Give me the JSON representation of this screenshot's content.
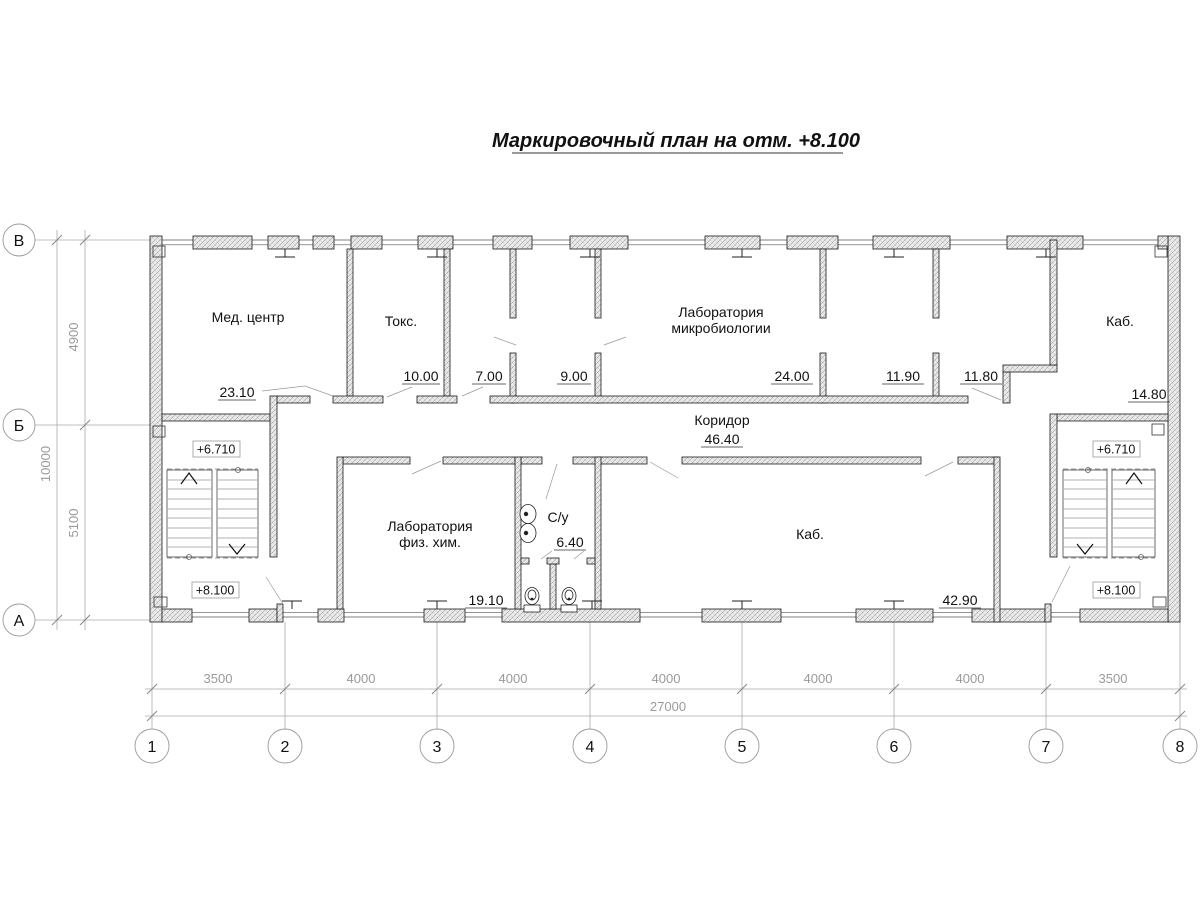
{
  "title": "Маркировочный план на отм. +8.100",
  "rooms": {
    "med_center": {
      "name": "Мед. центр",
      "area": "23.10"
    },
    "toks": {
      "name": "Токс.",
      "area": "10.00"
    },
    "room7": {
      "area": "7.00"
    },
    "room9": {
      "area": "9.00"
    },
    "lab_micro": {
      "line1": "Лаборатория",
      "line2": "микробиологии",
      "area": "24.00"
    },
    "room1190": {
      "area": "11.90"
    },
    "room1180": {
      "area": "11.80"
    },
    "kab_top": {
      "name": "Каб.",
      "area": "14.80"
    },
    "corridor": {
      "name": "Коридор",
      "area": "46.40"
    },
    "lab_fizhim": {
      "line1": "Лаборатория",
      "line2": "физ. хим.",
      "area": "19.10"
    },
    "su": {
      "name": "С/у",
      "area": "6.40"
    },
    "kab_main": {
      "name": "Каб.",
      "area": "42.90"
    }
  },
  "elevations": {
    "upper": "+6.710",
    "lower": "+8.100"
  },
  "axes": {
    "rows": [
      "В",
      "Б",
      "А"
    ],
    "cols": [
      "1",
      "2",
      "3",
      "4",
      "5",
      "6",
      "7",
      "8"
    ]
  },
  "dims": {
    "left": {
      "segments": [
        "4900",
        "5100"
      ],
      "total": "10000"
    },
    "bottom": {
      "segments": [
        "3500",
        "4000",
        "4000",
        "4000",
        "4000",
        "4000",
        "3500"
      ],
      "total": "27000"
    }
  }
}
